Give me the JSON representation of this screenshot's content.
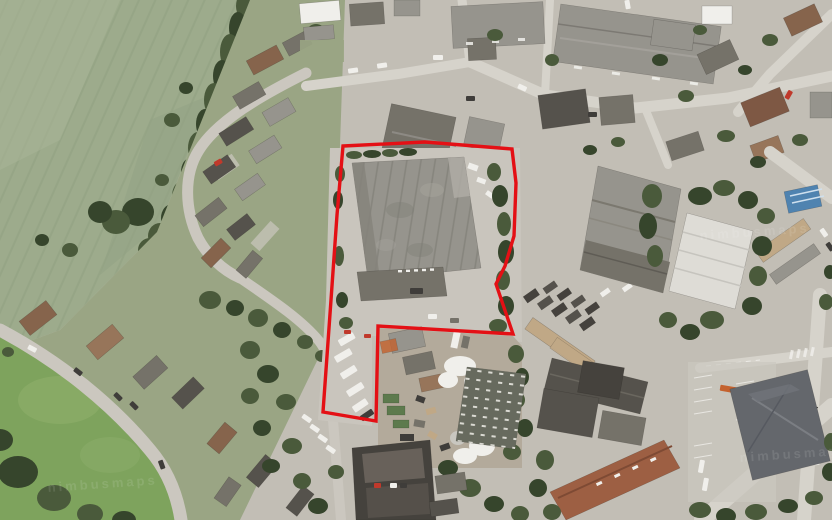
{
  "map": {
    "type": "aerial-satellite-photo",
    "description": "Aerial view of an industrial site amid housing, with a red site boundary drawn around warehouse and yard",
    "watermark_text": "nimbusmaps",
    "boundary": {
      "color": "#e41015",
      "stroke_width": 3.4,
      "points": "343,146 425,142 512,149 516,183 514,236 505,266 496,284 513,334 378,326 376,421 323,412 331,300 337,215"
    },
    "regions": [
      {
        "name": "arable-field",
        "label": "green arable field with tramlines",
        "color": "#9dab8c"
      },
      {
        "name": "hedgerow",
        "label": "tree hedgerow along field edge",
        "color": "#46543a"
      },
      {
        "name": "left-residential",
        "label": "housing estate with curving street",
        "color": "#9aa584"
      },
      {
        "name": "park-green",
        "label": "open green with curving road",
        "color": "#7ea35d"
      },
      {
        "name": "subject-site",
        "label": "warehouse and yard inside red boundary",
        "color": "#96948d"
      },
      {
        "name": "scrapyard",
        "label": "cluttered scrap yard with white bags",
        "color": "#b3aa9b"
      },
      {
        "name": "right-industrial",
        "label": "industrial estate warehouses",
        "color": "#8e8c86"
      },
      {
        "name": "bottom-right-industrial",
        "label": "large units, rusty roof shed, car parks",
        "color": "#64676c"
      }
    ],
    "palette": {
      "ground": "#c2beb5",
      "field": "#9dab8c",
      "gardens": "#9aa584",
      "park": "#7ea35d",
      "parkLight": "#8fb06c",
      "tree": "#4a5a3b",
      "treeDark": "#36452c",
      "road": "#cbc7bf",
      "roadLight": "#d6d3cb",
      "concrete": "#c9c5bd",
      "scrapGround": "#b3aa9b",
      "roofGray": "#96948d",
      "roofGrayDark": "#757269",
      "roofDark": "#55524c",
      "roofDarker": "#45423d",
      "roofBrown": "#86644c",
      "roofBrownLight": "#97755a",
      "roofRed": "#7e5844",
      "roofRust": "#9d5f43",
      "roofWhite": "#dedcd6",
      "bigDark": "#64676c",
      "blueCanopy": "#4f83b0",
      "beige": "#c0a886",
      "white": "#f0efeb",
      "carDark": "#3f3d3a",
      "carRed": "#c0392b",
      "orange": "#c4622e",
      "greenContainer": "#5d7a4d",
      "boundary": "#e41015"
    }
  }
}
